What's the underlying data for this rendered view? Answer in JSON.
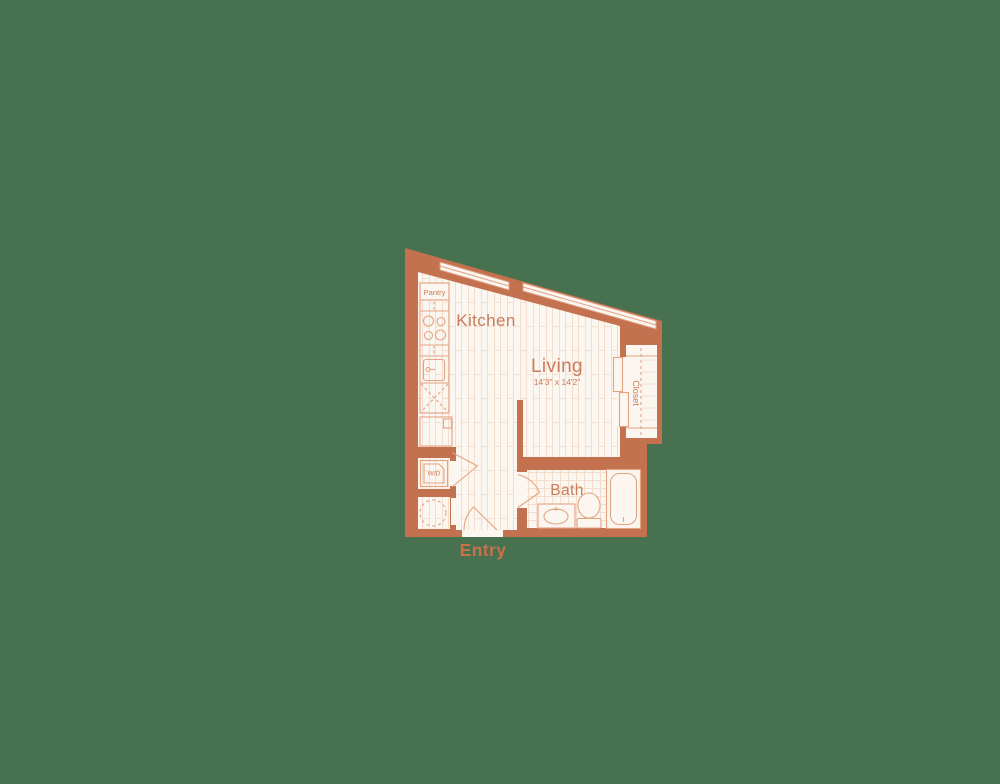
{
  "page": {
    "type": "apartment-floor-plan"
  },
  "colors": {
    "background": "#47714F",
    "wall": "#C3714E",
    "floor": "#FBF6F0",
    "fixture_line": "#E3A482",
    "pattern_line": "#F3DECD",
    "glazing_line": "#E0A183",
    "label": "#C97C59",
    "entry_label": "#C9714C"
  },
  "labels": {
    "pantry": "Pantry",
    "kitchen": "Kitchen",
    "living": "Living",
    "living_dimensions": "14'3\" x 14'2\"",
    "closet": "Closet",
    "bath": "Bath",
    "washer_dryer": "W/D",
    "entry": "Entry"
  }
}
